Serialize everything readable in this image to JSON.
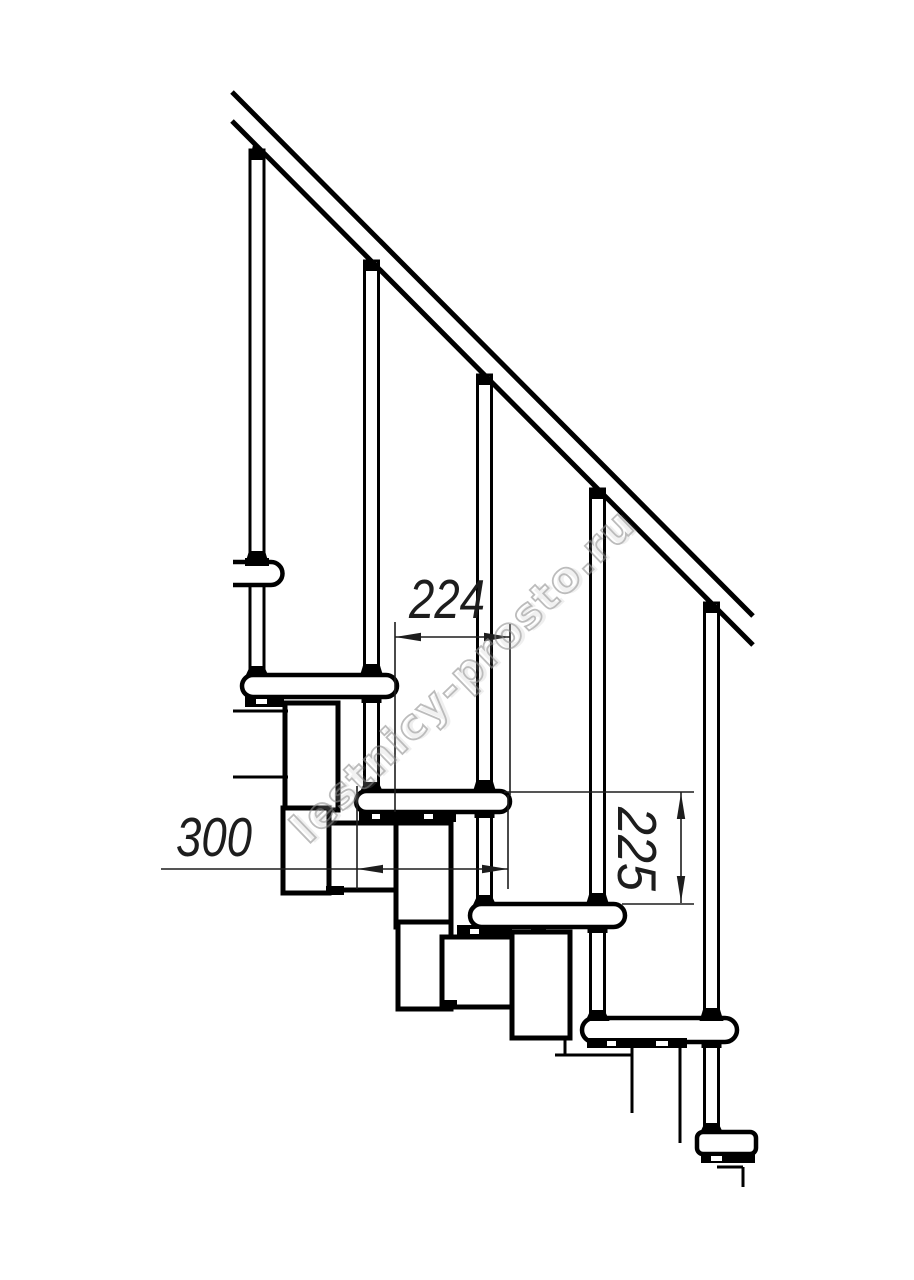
{
  "drawing": {
    "background": "#ffffff",
    "line_color": "#000000",
    "dimension_color": "#1d1d1d",
    "dimensions": {
      "step_run": {
        "label": "224",
        "orientation": "horizontal"
      },
      "tread_depth": {
        "label": "300",
        "orientation": "horizontal"
      },
      "step_rise": {
        "label": "225",
        "orientation": "vertical"
      }
    },
    "watermark": {
      "text": "lestnicy-prosto.ru",
      "color": "#949494"
    }
  }
}
